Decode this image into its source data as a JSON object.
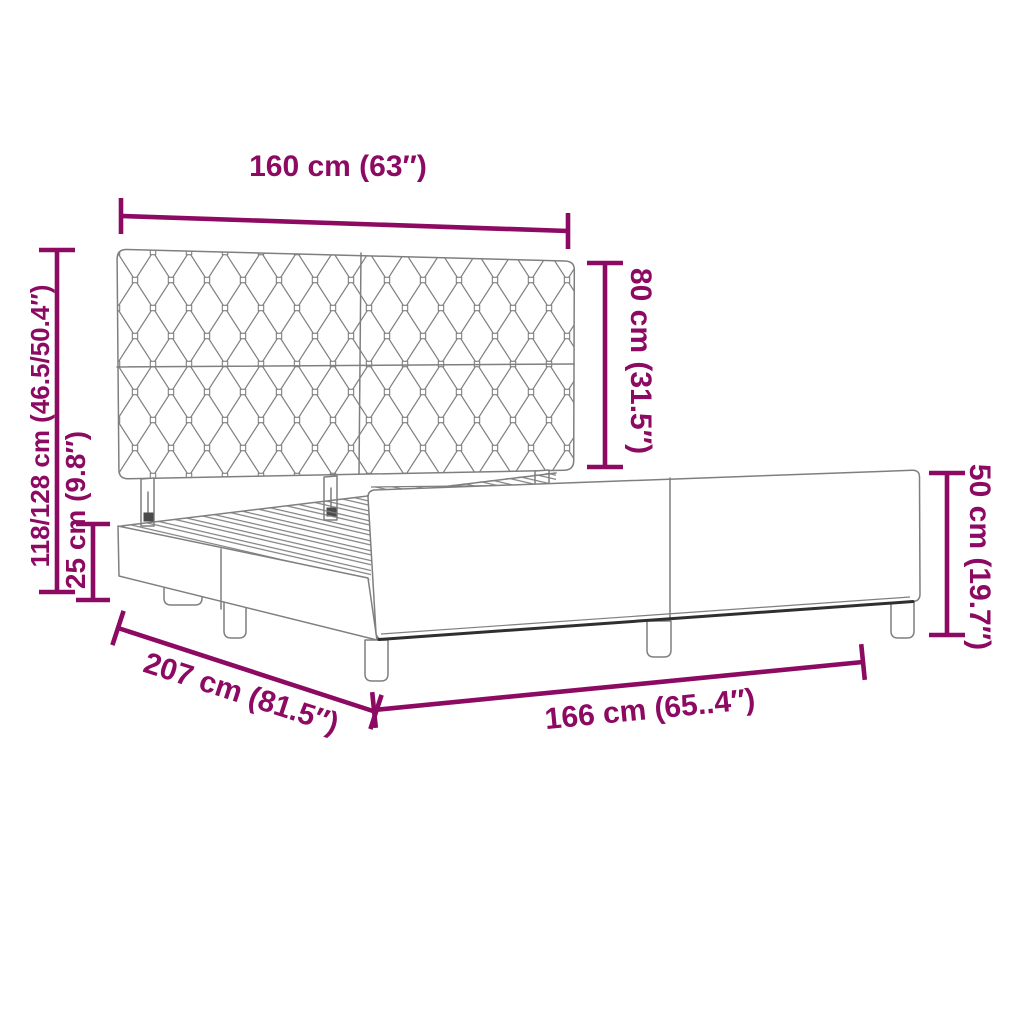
{
  "diagram": {
    "subject": "bed-frame-with-tufted-headboard-dimension-diagram"
  },
  "colors": {
    "accent": "#8c0a62",
    "line": "#7f7f7f",
    "shadow": "#2f2f2f",
    "bg": "#ffffff"
  },
  "dimensions": {
    "headboard_width": "160 cm (63″)",
    "headboard_height": "80 cm (31.5″)",
    "overall_height": "118/128 cm (46.5/50.4″)",
    "base_height": "25 cm (9.8″)",
    "frame_length": "207 cm (81.5″)",
    "frame_end_width": "166 cm (65..4″)",
    "footboard_height": "50 cm (19.7″)"
  }
}
